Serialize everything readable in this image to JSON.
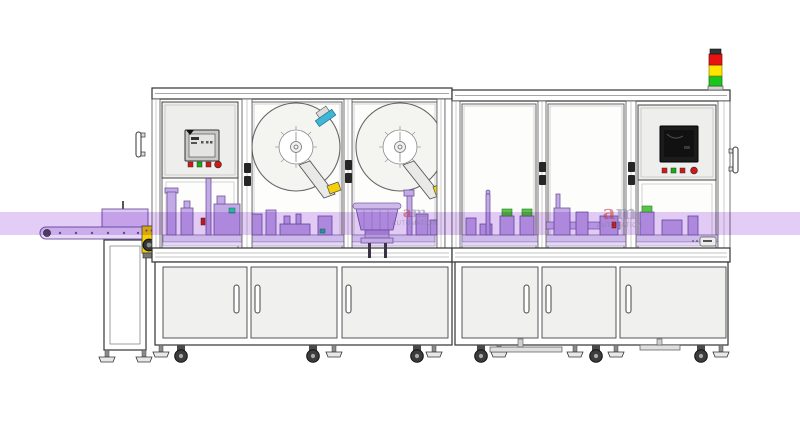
{
  "watermarks": [
    {
      "logo": "am",
      "label": "AUTOMATION"
    },
    {
      "logo": "am",
      "label": "AUTOMATION"
    }
  ],
  "band": {
    "color": "#c89aee"
  },
  "signal_tower": {
    "cap": "#333333",
    "red": "#e81212",
    "yellow": "#ffe400",
    "green": "#1dc41d",
    "base": "#d2d2d2"
  },
  "buttons": {
    "red": "#d81515",
    "green": "#13b013"
  },
  "accents": {
    "yellow": "#f3d106",
    "teal": "#2bb5a0",
    "blue": "#3fb6d6",
    "green_cap": "#58c34a",
    "red_part": "#cc2222",
    "machinery_purple": "#c3aae4",
    "machinery_outline": "#6f55a0"
  }
}
